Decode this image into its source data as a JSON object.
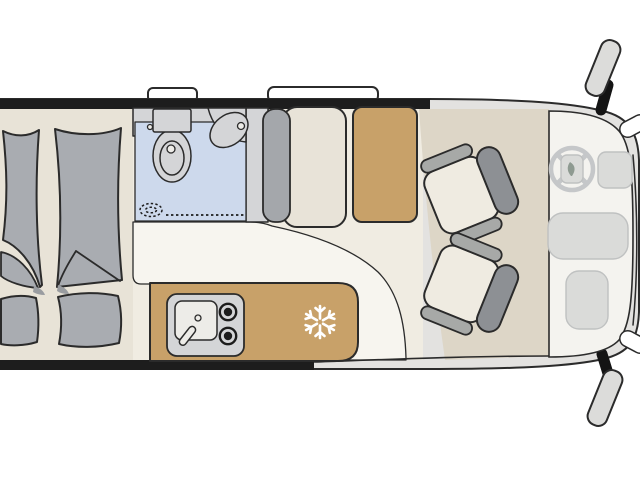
{
  "diagram": {
    "type": "campervan-floorplan",
    "view": "top-down layout drawing, vehicle front at the right",
    "zones": [
      {
        "id": "rear-beds",
        "label": "Two rear single beds with blankets and pillows"
      },
      {
        "id": "washroom",
        "label": "Washroom with toilet, corner washbasin and shower drain"
      },
      {
        "id": "bench-seat",
        "label": "Forward-facing bench seat with backrest"
      },
      {
        "id": "tall-cabinet",
        "label": "Wardrobe / tall cabinet"
      },
      {
        "id": "kitchen",
        "label": "Kitchen block with sink, faucet, two-burner hob and refrigerator"
      },
      {
        "id": "cab",
        "label": "Driver cab with two swivelled seats, steering wheel, centre console and glove box"
      }
    ],
    "icons": [
      {
        "name": "snowflake-icon",
        "meaning": "refrigerator / freezer position"
      }
    ],
    "exterior_features": [
      {
        "name": "roof-window-small"
      },
      {
        "name": "roof-window-large"
      },
      {
        "name": "side-mirror-left"
      },
      {
        "name": "side-mirror-right"
      }
    ]
  },
  "colors": {
    "page_bg": "#ffffff",
    "wall": "#1d1d1d",
    "outline": "#2b2b2b",
    "body_gray": "#e3e2e0",
    "floor_rear": "#e8e3d7",
    "floor_mid": "#f0ece2",
    "floor_entry_white": "#f7f5ef",
    "floor_cab": "#ddd6c7",
    "dash_floor": "#f4f3ef",
    "bath_floor": "#cdd9ec",
    "fixture_gray": "#d4d5d7",
    "fixture_white": "#edece8",
    "bed_gray": "#a9acb1",
    "shadow_gray": "#999ca0",
    "cabinet_tan": "#c8a169",
    "bench_cream": "#e8e3d8",
    "seat_cushion": "#efebe1",
    "seat_back_gray": "#8d9094",
    "armrest_gray": "#a7a9a7",
    "bench_back_gray": "#a4a7ab",
    "dash_element": "#dadbd9",
    "dash_element_line": "#bfc1c1",
    "steering_gray": "#c5c7c9",
    "hub_leaf": "#8e9a91",
    "mirror_gray": "#dcdcda",
    "mount_black": "#141414",
    "burner_black": "#1c1c1c",
    "snowflake_white": "#ffffff",
    "window_white": "#ffffff"
  }
}
